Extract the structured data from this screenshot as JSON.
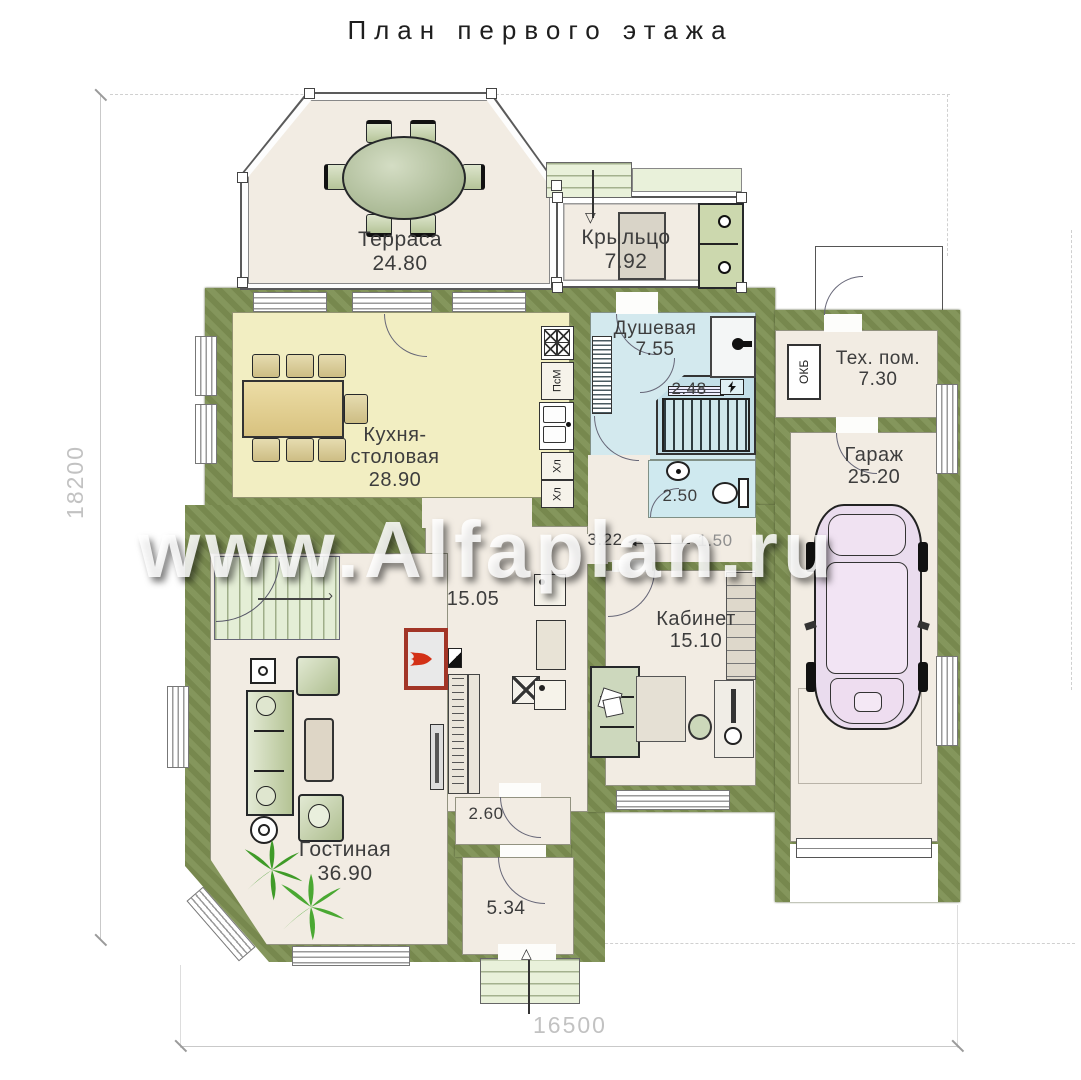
{
  "title": "План первого этажа",
  "watermark": "www.Alfaplan.ru",
  "dimensions": {
    "vertical": "18200",
    "horizontal": "16500"
  },
  "rooms": {
    "terrace": {
      "name": "Терраса",
      "area": "24.80"
    },
    "porch": {
      "name": "Крыльцо",
      "area": "7.92"
    },
    "kitchen": {
      "name": "Кухня-столовая",
      "area": "28.90"
    },
    "shower": {
      "name": "Душевая",
      "area": "7.55"
    },
    "sauna": {
      "area": "2.48"
    },
    "wc": {
      "area": "2.50"
    },
    "hallway": {
      "area_left": "3.22",
      "area_right": "1.50"
    },
    "tech": {
      "name": "Тех. пом.",
      "area": "7.30"
    },
    "garage": {
      "name": "Гараж",
      "area": "25.20"
    },
    "cabinet": {
      "name": "Кабинет",
      "area": "15.10"
    },
    "hall": {
      "area": "15.05"
    },
    "corridor": {
      "area": "2.60"
    },
    "entry": {
      "area": "5.34"
    },
    "living": {
      "name": "Гостиная",
      "area": "36.90"
    }
  },
  "labels": {
    "dishwasher": "ПсМ",
    "fridge_top": "Хл",
    "fridge_bottom": "Хл",
    "boiler": "ОКБ"
  },
  "glyphs": {
    "arrow_down": "▽",
    "arrow_up": "△",
    "arrow_left": "◀",
    "chevron_right": "›"
  }
}
